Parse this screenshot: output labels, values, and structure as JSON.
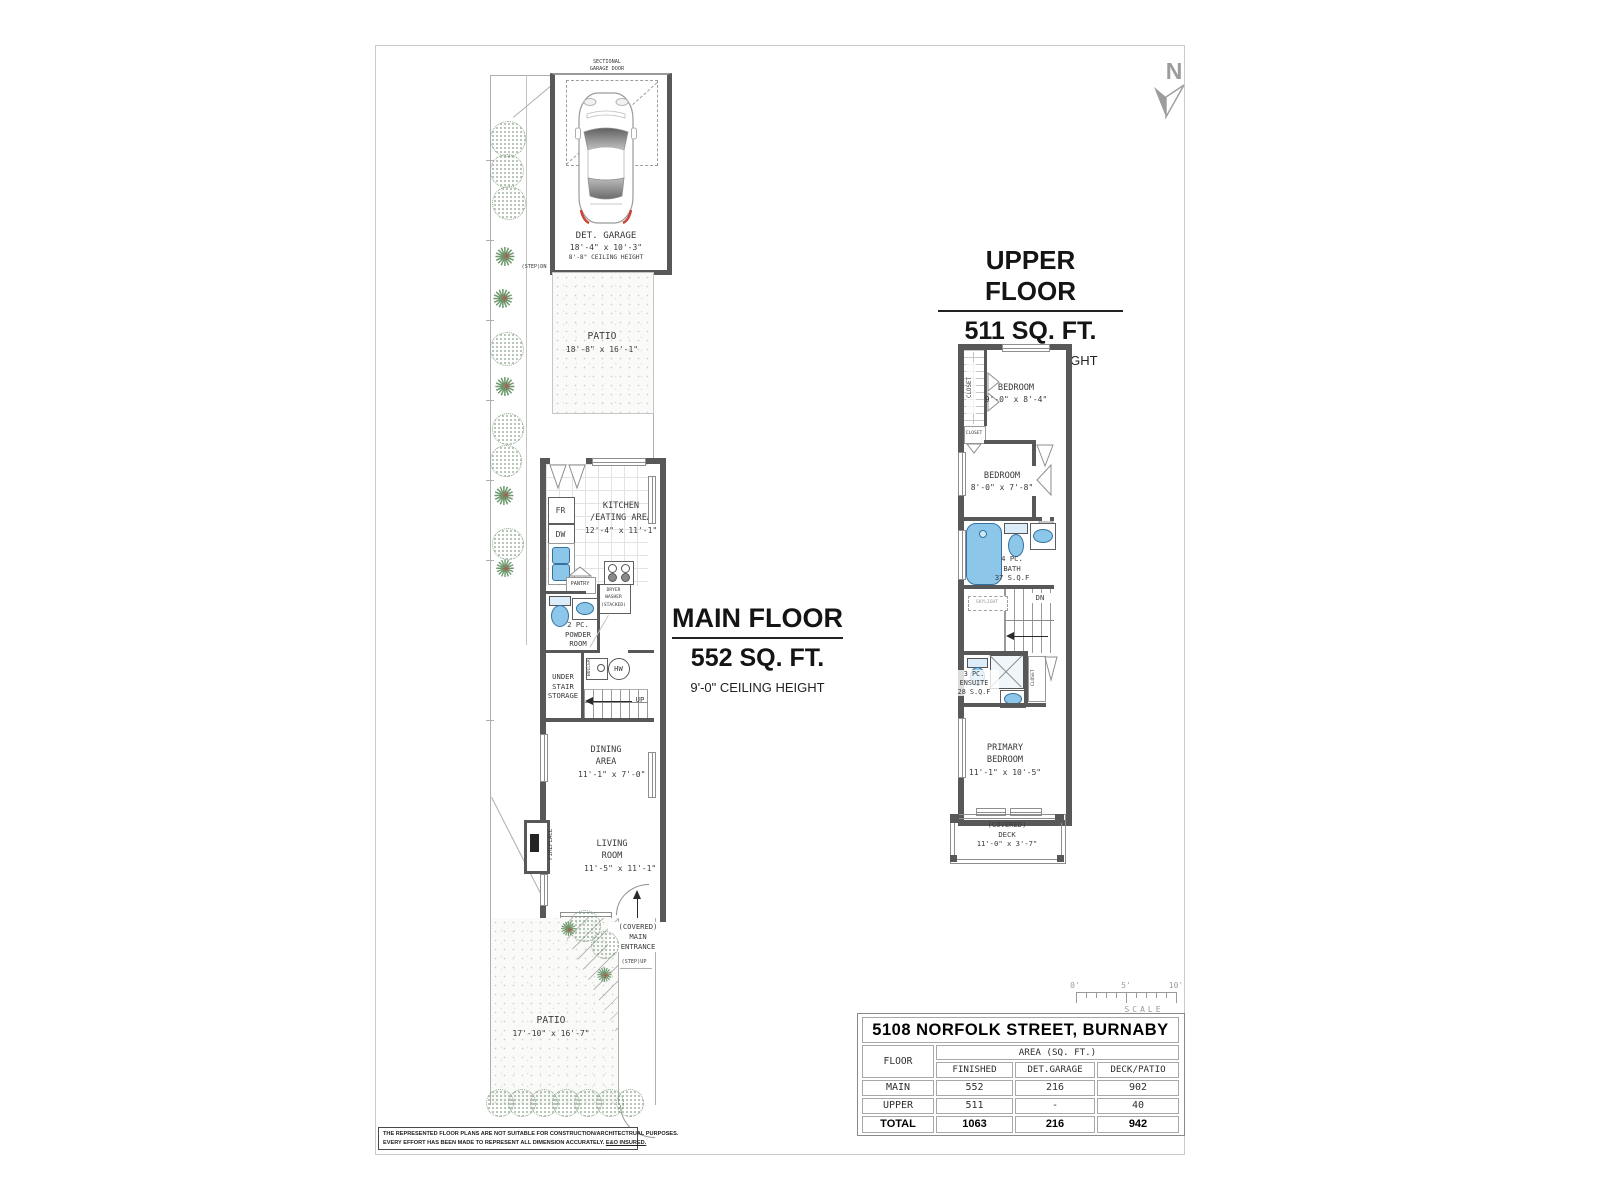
{
  "north": {
    "label": "N"
  },
  "main": {
    "title": "MAIN FLOOR",
    "area": "552 SQ. FT.",
    "ceiling": "9'-0\" CEILING HEIGHT",
    "garage_door_l1": "SECTIONAL",
    "garage_door_l2": "GARAGE DOOR",
    "garage_l1": "DET. GARAGE",
    "garage_l2": "18'-4\" x 10'-3\"",
    "garage_l3": "8'-8\" CEILING HEIGHT",
    "step_dn": "(STEP)DN",
    "patio_top_l1": "PATIO",
    "patio_top_l2": "18'-8\" x 16'-1\"",
    "fr": "FR",
    "dw": "DW",
    "kitchen_l1": "KITCHEN",
    "kitchen_l2": "/EATING AREA",
    "kitchen_l3": "12'-4\" x 11'-1\"",
    "pantry": "PANTRY",
    "laundry_l1": "DRYER",
    "laundry_l2": "WASHER",
    "laundry_l3": "(STACKED)",
    "powder_l1": "2 PC.",
    "powder_l2": "POWDER",
    "powder_l3": "ROOM",
    "storage_l1": "UNDER",
    "storage_l2": "STAIR",
    "storage_l3": "STORAGE",
    "boiler": "BOILER",
    "hw": "HW",
    "up": "UP",
    "dining_l1": "DINING",
    "dining_l2": "AREA",
    "dining_l3": "11'-1\" x 7'-0\"",
    "fireplace": "FIREPLACE",
    "living_l1": "LIVING",
    "living_l2": "ROOM",
    "living_l3": "11'-5\" x 11'-1\"",
    "entrance_l1": "(COVERED)",
    "entrance_l2": "MAIN",
    "entrance_l3": "ENTRANCE",
    "step_up": "(STEP)UP",
    "patio_bottom_l1": "PATIO",
    "patio_bottom_l2": "17'-10\" x 16'-7\""
  },
  "upper": {
    "title": "UPPER FLOOR",
    "area": "511 SQ. FT.",
    "ceiling": "8'-0\" CEILING HEIGHT",
    "closet1": "CLOSET",
    "closet2": "CLOSET",
    "closet3": "CLOSET",
    "bedroom1_l1": "BEDROOM",
    "bedroom1_l2": "9'-0\" x 8'-4\"",
    "bedroom2_l1": "BEDROOM",
    "bedroom2_l2": "8'-0\" x 7'-8\"",
    "bath_l1": "4 PC.",
    "bath_l2": "BATH",
    "bath_l3": "37 S.Q.F",
    "skylight": "SKYLIGHT",
    "dn": "DN",
    "ensuite_l1": "3 PC.",
    "ensuite_l2": "ENSUITE",
    "ensuite_l3": "28 S.Q.F",
    "primary_l1": "PRIMARY",
    "primary_l2": "BEDROOM",
    "primary_l3": "11'-1\" x 10'-5\"",
    "deck_l1": "(COVERED)",
    "deck_l2": "DECK",
    "deck_l3": "11'-0\" x 3'-7\""
  },
  "scale": {
    "t0": "0'",
    "t5": "5'",
    "t10": "10'",
    "label": "SCALE"
  },
  "table": {
    "title": "5108 NORFOLK STREET, BURNABY",
    "floor": "FLOOR",
    "area_header": "AREA (SQ. FT.)",
    "cols": [
      "FINISHED",
      "DET.GARAGE",
      "DECK/PATIO"
    ],
    "rows": [
      {
        "name": "MAIN",
        "finished": "552",
        "garage": "216",
        "deck": "902"
      },
      {
        "name": "UPPER",
        "finished": "511",
        "garage": "-",
        "deck": "40"
      },
      {
        "name": "TOTAL",
        "finished": "1063",
        "garage": "216",
        "deck": "942"
      }
    ]
  },
  "disclaimer": {
    "line1": "THE REPRESENTED FLOOR PLANS ARE NOT SUITABLE FOR CONSTRUCTION/ARCHITECTRUAL PURPOSES.",
    "line2": "EVERY EFFORT HAS BEEN MADE TO REPRESENT ALL DIMENSION ACCURATELY. ",
    "line2_underlined": "E&O INSURED."
  },
  "colors": {
    "wall": "#585858",
    "fixture_blue": "#8cc6e8",
    "plant_green": "#6f9a6f",
    "accent_red": "#cc4434"
  }
}
